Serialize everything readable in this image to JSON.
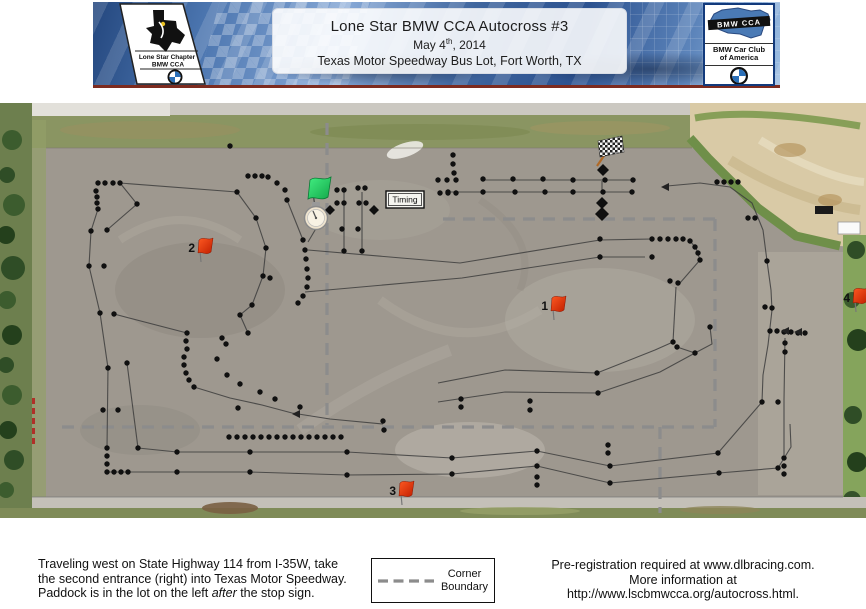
{
  "header": {
    "title": "Lone Star BMW CCA  Autocross #3",
    "date_prefix": "May 4",
    "date_sup": "th",
    "date_suffix": ", 2014",
    "location": "Texas Motor Speedway Bus Lot, Fort Worth, TX",
    "left_logo": {
      "line1": "Lone Star Chapter",
      "line2": "BMW CCA"
    },
    "right_logo": {
      "band": "BMW CCA",
      "name_line1": "BMW Car Club",
      "name_line2": "of America"
    }
  },
  "footer": {
    "directions_line1": "Traveling west on State Highway 114 from I-35W, take",
    "directions_line2": "the second entrance (right) into Texas Motor Speedway.",
    "directions_line3_pre": "Paddock is in the lot on the left ",
    "directions_line3_italic": "after",
    "directions_line3_post": " the stop sign.",
    "legend": {
      "label_line1": "Corner",
      "label_line2": "Boundary"
    },
    "registration_line1": "Pre-registration required at www.dlbracing.com.",
    "registration_line2": "More information at",
    "registration_line3": "http://www.lscbmwcca.org/autocross.html."
  },
  "map": {
    "timing_label": "Timing",
    "colors": {
      "asphalt": "#9e988f",
      "grass": "#8a9562",
      "trees": "#4c6b38",
      "tan": "#d9caa6",
      "line": "#3d3d3d",
      "dashed": "#8c8c8c",
      "cone": "#101010",
      "flag_red": "#e03414",
      "flag_green": "#2fd968",
      "pole_brown": "#b06a28"
    },
    "corner_flags": [
      {
        "number": "1",
        "x": 552,
        "y": 298
      },
      {
        "number": "2",
        "x": 199,
        "y": 240
      },
      {
        "number": "3",
        "x": 400,
        "y": 483
      },
      {
        "number": "4",
        "x": 854,
        "y": 290
      }
    ],
    "cones": [
      [
        98,
        183
      ],
      [
        105,
        183
      ],
      [
        113,
        183
      ],
      [
        120,
        183
      ],
      [
        96,
        191
      ],
      [
        97,
        197
      ],
      [
        97,
        203
      ],
      [
        98,
        209
      ],
      [
        137,
        204
      ],
      [
        91,
        231
      ],
      [
        107,
        230
      ],
      [
        89,
        266
      ],
      [
        104,
        266
      ],
      [
        100,
        313
      ],
      [
        114,
        314
      ],
      [
        230,
        146
      ],
      [
        108,
        368
      ],
      [
        127,
        363
      ],
      [
        103,
        410
      ],
      [
        118,
        410
      ],
      [
        107,
        448
      ],
      [
        107,
        456
      ],
      [
        107,
        464
      ],
      [
        107,
        472
      ],
      [
        114,
        472
      ],
      [
        121,
        472
      ],
      [
        128,
        472
      ],
      [
        138,
        448
      ],
      [
        237,
        192
      ],
      [
        248,
        176
      ],
      [
        255,
        176
      ],
      [
        262,
        176
      ],
      [
        268,
        177
      ],
      [
        277,
        183
      ],
      [
        285,
        190
      ],
      [
        287,
        200
      ],
      [
        256,
        218
      ],
      [
        266,
        248
      ],
      [
        263,
        276
      ],
      [
        270,
        278
      ],
      [
        252,
        305
      ],
      [
        240,
        315
      ],
      [
        248,
        333
      ],
      [
        222,
        338
      ],
      [
        226,
        344
      ],
      [
        303,
        240
      ],
      [
        305,
        250
      ],
      [
        306,
        259
      ],
      [
        307,
        269
      ],
      [
        308,
        278
      ],
      [
        307,
        287
      ],
      [
        303,
        296
      ],
      [
        298,
        303
      ],
      [
        187,
        333
      ],
      [
        186,
        341
      ],
      [
        187,
        349
      ],
      [
        184,
        357
      ],
      [
        184,
        365
      ],
      [
        186,
        373
      ],
      [
        189,
        380
      ],
      [
        194,
        387
      ],
      [
        217,
        359
      ],
      [
        227,
        375
      ],
      [
        240,
        384
      ],
      [
        260,
        392
      ],
      [
        275,
        399
      ],
      [
        300,
        407
      ],
      [
        238,
        408
      ],
      [
        229,
        437
      ],
      [
        237,
        437
      ],
      [
        245,
        437
      ],
      [
        253,
        437
      ],
      [
        261,
        437
      ],
      [
        269,
        437
      ],
      [
        277,
        437
      ],
      [
        285,
        437
      ],
      [
        293,
        437
      ],
      [
        301,
        437
      ],
      [
        309,
        437
      ],
      [
        317,
        437
      ],
      [
        325,
        437
      ],
      [
        333,
        437
      ],
      [
        341,
        437
      ],
      [
        177,
        452
      ],
      [
        250,
        452
      ],
      [
        347,
        452
      ],
      [
        452,
        458
      ],
      [
        537,
        451
      ],
      [
        610,
        466
      ],
      [
        718,
        453
      ],
      [
        177,
        472
      ],
      [
        250,
        472
      ],
      [
        347,
        475
      ],
      [
        452,
        474
      ],
      [
        537,
        466
      ],
      [
        610,
        483
      ],
      [
        719,
        473
      ],
      [
        778,
        468
      ],
      [
        383,
        421
      ],
      [
        384,
        430
      ],
      [
        461,
        399
      ],
      [
        461,
        407
      ],
      [
        530,
        401
      ],
      [
        530,
        410
      ],
      [
        608,
        445
      ],
      [
        608,
        453
      ],
      [
        537,
        477
      ],
      [
        537,
        485
      ],
      [
        784,
        458
      ],
      [
        784,
        466
      ],
      [
        784,
        474
      ],
      [
        337,
        190
      ],
      [
        344,
        190
      ],
      [
        358,
        188
      ],
      [
        365,
        188
      ],
      [
        337,
        203
      ],
      [
        344,
        203
      ],
      [
        359,
        203
      ],
      [
        366,
        203
      ],
      [
        342,
        229
      ],
      [
        358,
        229
      ],
      [
        344,
        251
      ],
      [
        362,
        251
      ],
      [
        483,
        179
      ],
      [
        513,
        179
      ],
      [
        543,
        179
      ],
      [
        573,
        180
      ],
      [
        605,
        180
      ],
      [
        633,
        180
      ],
      [
        448,
        192
      ],
      [
        483,
        192
      ],
      [
        515,
        192
      ],
      [
        545,
        192
      ],
      [
        573,
        192
      ],
      [
        603,
        192
      ],
      [
        632,
        192
      ],
      [
        438,
        180
      ],
      [
        447,
        180
      ],
      [
        456,
        180
      ],
      [
        453,
        155
      ],
      [
        453,
        164
      ],
      [
        454,
        173
      ],
      [
        440,
        193
      ],
      [
        448,
        193
      ],
      [
        456,
        193
      ],
      [
        717,
        182
      ],
      [
        724,
        182
      ],
      [
        731,
        182
      ],
      [
        738,
        182
      ],
      [
        748,
        218
      ],
      [
        755,
        218
      ],
      [
        600,
        239
      ],
      [
        600,
        257
      ],
      [
        652,
        257
      ],
      [
        652,
        239
      ],
      [
        660,
        239
      ],
      [
        668,
        239
      ],
      [
        676,
        239
      ],
      [
        683,
        239
      ],
      [
        690,
        241
      ],
      [
        695,
        247
      ],
      [
        698,
        253
      ],
      [
        700,
        260
      ],
      [
        670,
        281
      ],
      [
        678,
        283
      ],
      [
        673,
        342
      ],
      [
        677,
        347
      ],
      [
        695,
        353
      ],
      [
        710,
        327
      ],
      [
        597,
        373
      ],
      [
        598,
        393
      ],
      [
        770,
        331
      ],
      [
        777,
        331
      ],
      [
        784,
        332
      ],
      [
        791,
        332
      ],
      [
        798,
        333
      ],
      [
        805,
        333
      ],
      [
        785,
        343
      ],
      [
        785,
        352
      ],
      [
        767,
        261
      ],
      [
        762,
        402
      ],
      [
        778,
        402
      ],
      [
        772,
        308
      ],
      [
        765,
        307
      ]
    ],
    "lines": [
      [
        [
          120,
          183
        ],
        [
          237,
          192
        ]
      ],
      [
        [
          98,
          209
        ],
        [
          91,
          231
        ],
        [
          89,
          266
        ],
        [
          100,
          313
        ]
      ],
      [
        [
          120,
          183
        ],
        [
          137,
          204
        ],
        [
          107,
          230
        ]
      ],
      [
        [
          287,
          200
        ],
        [
          303,
          240
        ]
      ],
      [
        [
          237,
          192
        ],
        [
          256,
          218
        ],
        [
          266,
          248
        ],
        [
          263,
          276
        ],
        [
          252,
          305
        ],
        [
          240,
          315
        ],
        [
          248,
          333
        ]
      ],
      [
        [
          114,
          314
        ],
        [
          187,
          333
        ]
      ],
      [
        [
          100,
          313
        ],
        [
          108,
          368
        ]
      ],
      [
        [
          108,
          368
        ],
        [
          107,
          448
        ]
      ],
      [
        [
          127,
          363
        ],
        [
          138,
          448
        ]
      ],
      [
        [
          194,
          387
        ],
        [
          230,
          398
        ],
        [
          262,
          405
        ],
        [
          292,
          413
        ],
        [
          330,
          419
        ],
        [
          383,
          424
        ]
      ],
      [
        [
          138,
          448
        ],
        [
          177,
          452
        ],
        [
          250,
          452
        ],
        [
          347,
          452
        ],
        [
          452,
          458
        ],
        [
          537,
          451
        ],
        [
          610,
          466
        ],
        [
          718,
          453
        ],
        [
          762,
          402
        ]
      ],
      [
        [
          107,
          472
        ],
        [
          177,
          472
        ],
        [
          250,
          472
        ],
        [
          347,
          475
        ],
        [
          452,
          474
        ],
        [
          537,
          466
        ],
        [
          610,
          483
        ],
        [
          719,
          473
        ],
        [
          778,
          468
        ],
        [
          791,
          447
        ],
        [
          790,
          424
        ]
      ],
      [
        [
          667,
          186
        ],
        [
          700,
          183
        ],
        [
          730,
          187
        ],
        [
          752,
          203
        ],
        [
          763,
          230
        ],
        [
          767,
          261
        ],
        [
          771,
          290
        ],
        [
          772,
          310
        ],
        [
          768,
          345
        ],
        [
          763,
          375
        ],
        [
          762,
          402
        ]
      ],
      [
        [
          483,
          180
        ],
        [
          633,
          180
        ]
      ],
      [
        [
          448,
          192
        ],
        [
          632,
          192
        ]
      ],
      [
        [
          602,
          181
        ],
        [
          602,
          192
        ]
      ],
      [
        [
          600,
          240
        ],
        [
          652,
          239
        ]
      ],
      [
        [
          600,
          257
        ],
        [
          645,
          257
        ]
      ],
      [
        [
          308,
          250
        ],
        [
          460,
          263
        ],
        [
          600,
          240
        ]
      ],
      [
        [
          305,
          292
        ],
        [
          462,
          278
        ],
        [
          600,
          257
        ]
      ],
      [
        [
          690,
          241
        ],
        [
          696,
          248
        ],
        [
          700,
          260
        ],
        [
          680,
          283
        ]
      ],
      [
        [
          676,
          287
        ],
        [
          673,
          342
        ]
      ],
      [
        [
          677,
          347
        ],
        [
          695,
          353
        ],
        [
          712,
          344
        ],
        [
          710,
          327
        ]
      ],
      [
        [
          598,
          393
        ],
        [
          660,
          372
        ],
        [
          695,
          353
        ]
      ],
      [
        [
          597,
          373
        ],
        [
          655,
          350
        ],
        [
          673,
          342
        ]
      ],
      [
        [
          597,
          373
        ],
        [
          505,
          370
        ],
        [
          438,
          383
        ]
      ],
      [
        [
          598,
          393
        ],
        [
          505,
          392
        ],
        [
          438,
          402
        ]
      ],
      [
        [
          785,
          338
        ],
        [
          784,
          400
        ],
        [
          784,
          455
        ]
      ],
      [
        [
          344,
          192
        ],
        [
          344,
          250
        ]
      ],
      [
        [
          362,
          192
        ],
        [
          362,
          250
        ]
      ],
      [
        [
          327,
          210
        ],
        [
          308,
          242
        ]
      ]
    ],
    "dashed_boundaries": [
      [
        [
          327,
          123
        ],
        [
          327,
          425
        ]
      ],
      [
        [
          443,
          219
        ],
        [
          717,
          219
        ]
      ],
      [
        [
          715,
          219
        ],
        [
          715,
          427
        ]
      ],
      [
        [
          62,
          427
        ],
        [
          717,
          427
        ]
      ],
      [
        [
          660,
          427
        ],
        [
          660,
          513
        ]
      ]
    ],
    "diamonds": [
      [
        330,
        210,
        5
      ],
      [
        374,
        210,
        5
      ],
      [
        603,
        170,
        6
      ],
      [
        602,
        203,
        6
      ],
      [
        602,
        214,
        7
      ]
    ],
    "arrows": [
      [
        661,
        187
      ],
      [
        292,
        414
      ],
      [
        781,
        331
      ],
      [
        794,
        332
      ]
    ]
  }
}
